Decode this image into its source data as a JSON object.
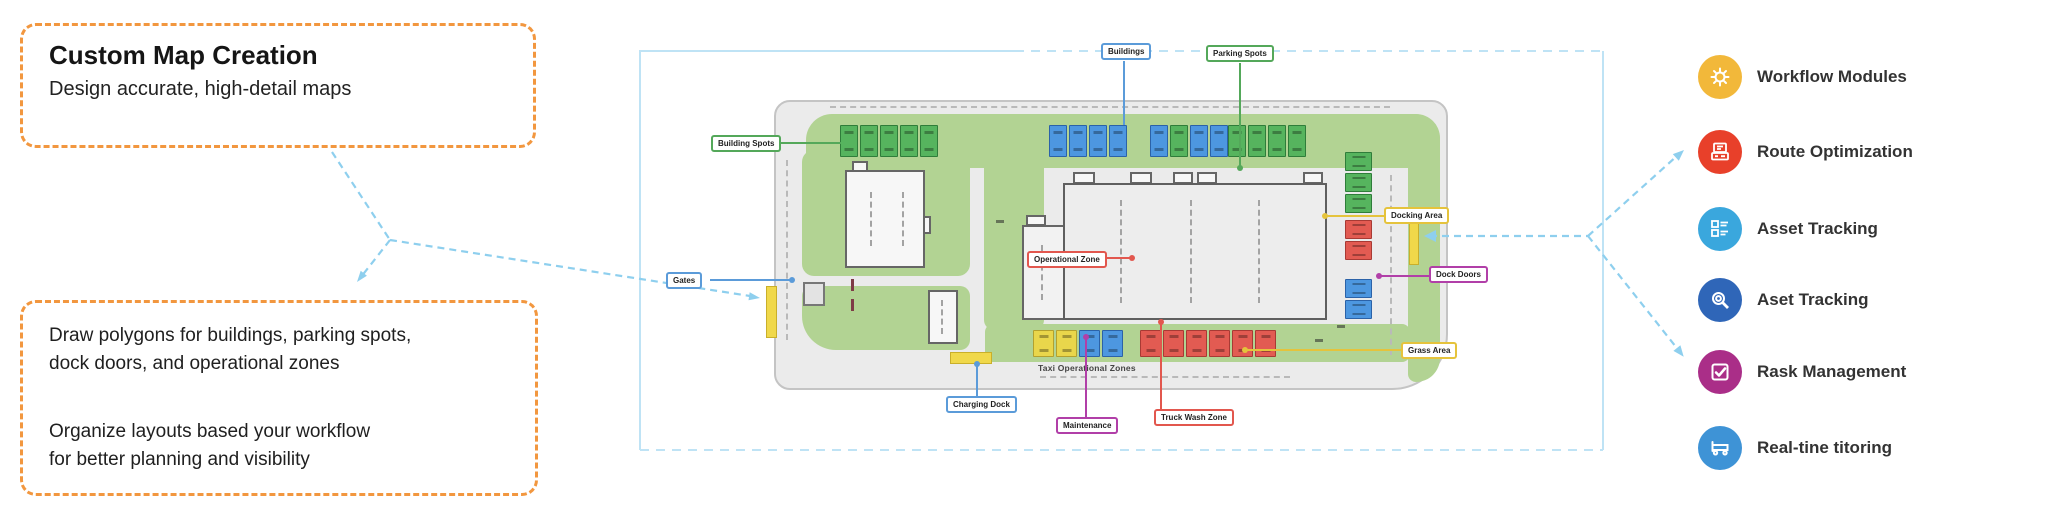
{
  "left_panel": {
    "box1": {
      "title": "Custom Map Creation",
      "subtitle": "Design accurate, high-detail maps"
    },
    "box2": {
      "line1": "Draw polygons for buildings, parking spots,",
      "line2": "dock doors, and operational zones",
      "line3": "Organize layouts based your workflow",
      "line4": "for better planning and visibility"
    }
  },
  "map": {
    "labels": {
      "buildings": "Buildings",
      "parking_spots": "Parking Spots",
      "building_spots": "Building Spots",
      "gates": "Gates",
      "operational_zone": "Operational Zone",
      "docking_area": "Docking Area",
      "dock_doors": "Dock Doors",
      "grass_area": "Grass Area",
      "charging_dock": "Charging Dock",
      "maintenance": "Maintenance",
      "truck_wash_zone": "Truck Wash Zone",
      "zones_caption": "Taxi Operational Zones"
    },
    "label_colors": {
      "blue": "#5b9bd9",
      "green": "#54a85a",
      "red": "#e2574e",
      "yellow": "#e5c33c",
      "purple": "#b13fa8"
    }
  },
  "features": [
    {
      "label": "Workflow Modules",
      "icon": "gear-icon",
      "color": "#f2b83a"
    },
    {
      "label": "Route Optimization",
      "icon": "route-device-icon",
      "color": "#e8402a"
    },
    {
      "label": "Asset Tracking",
      "icon": "clipboard-list-icon",
      "color": "#3aa7dd"
    },
    {
      "label": "Aset Tracking",
      "icon": "magnifier-icon",
      "color": "#2f66b8"
    },
    {
      "label": "Rask Management",
      "icon": "check-square-icon",
      "color": "#aa2e88"
    },
    {
      "label": "Real-tine titoring",
      "icon": "truck-icon",
      "color": "#3e93d6"
    }
  ],
  "colors": {
    "accent_orange": "#f2973f",
    "arrow_blue": "#8ecfee",
    "frame_blue": "#bfe3f5",
    "map_green": "#b2d393",
    "spot_green": "#56b45e",
    "spot_blue": "#4d97e0",
    "spot_red": "#e25b52",
    "spot_yellow": "#e9d64b"
  }
}
